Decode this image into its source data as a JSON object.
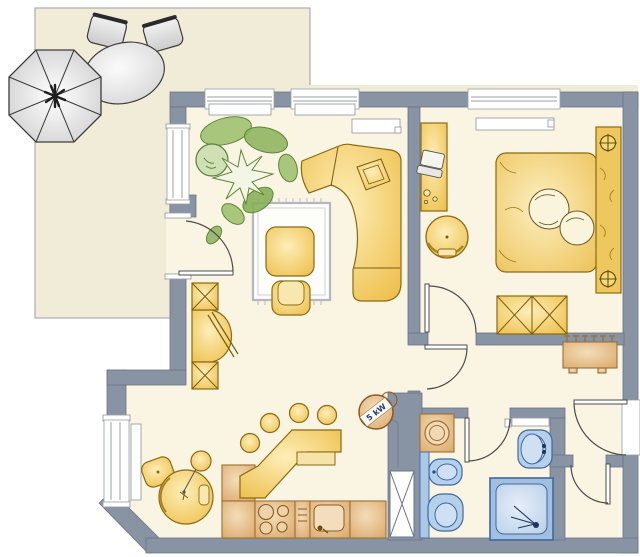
{
  "plan": {
    "title": "apartment-floor-plan",
    "stove_label": "5 kW",
    "colors": {
      "wall_gray": "#8893a3",
      "floor_cream": "#faf4e2",
      "terrace_beige": "#f1ecd8",
      "furniture_yellow": "#eec04e",
      "kitchen_tan": "#ddab6e",
      "sanitary_blue": "#b5d0eb",
      "plant_green": "#8db45e",
      "outline_dark": "#4c4c4c"
    }
  }
}
